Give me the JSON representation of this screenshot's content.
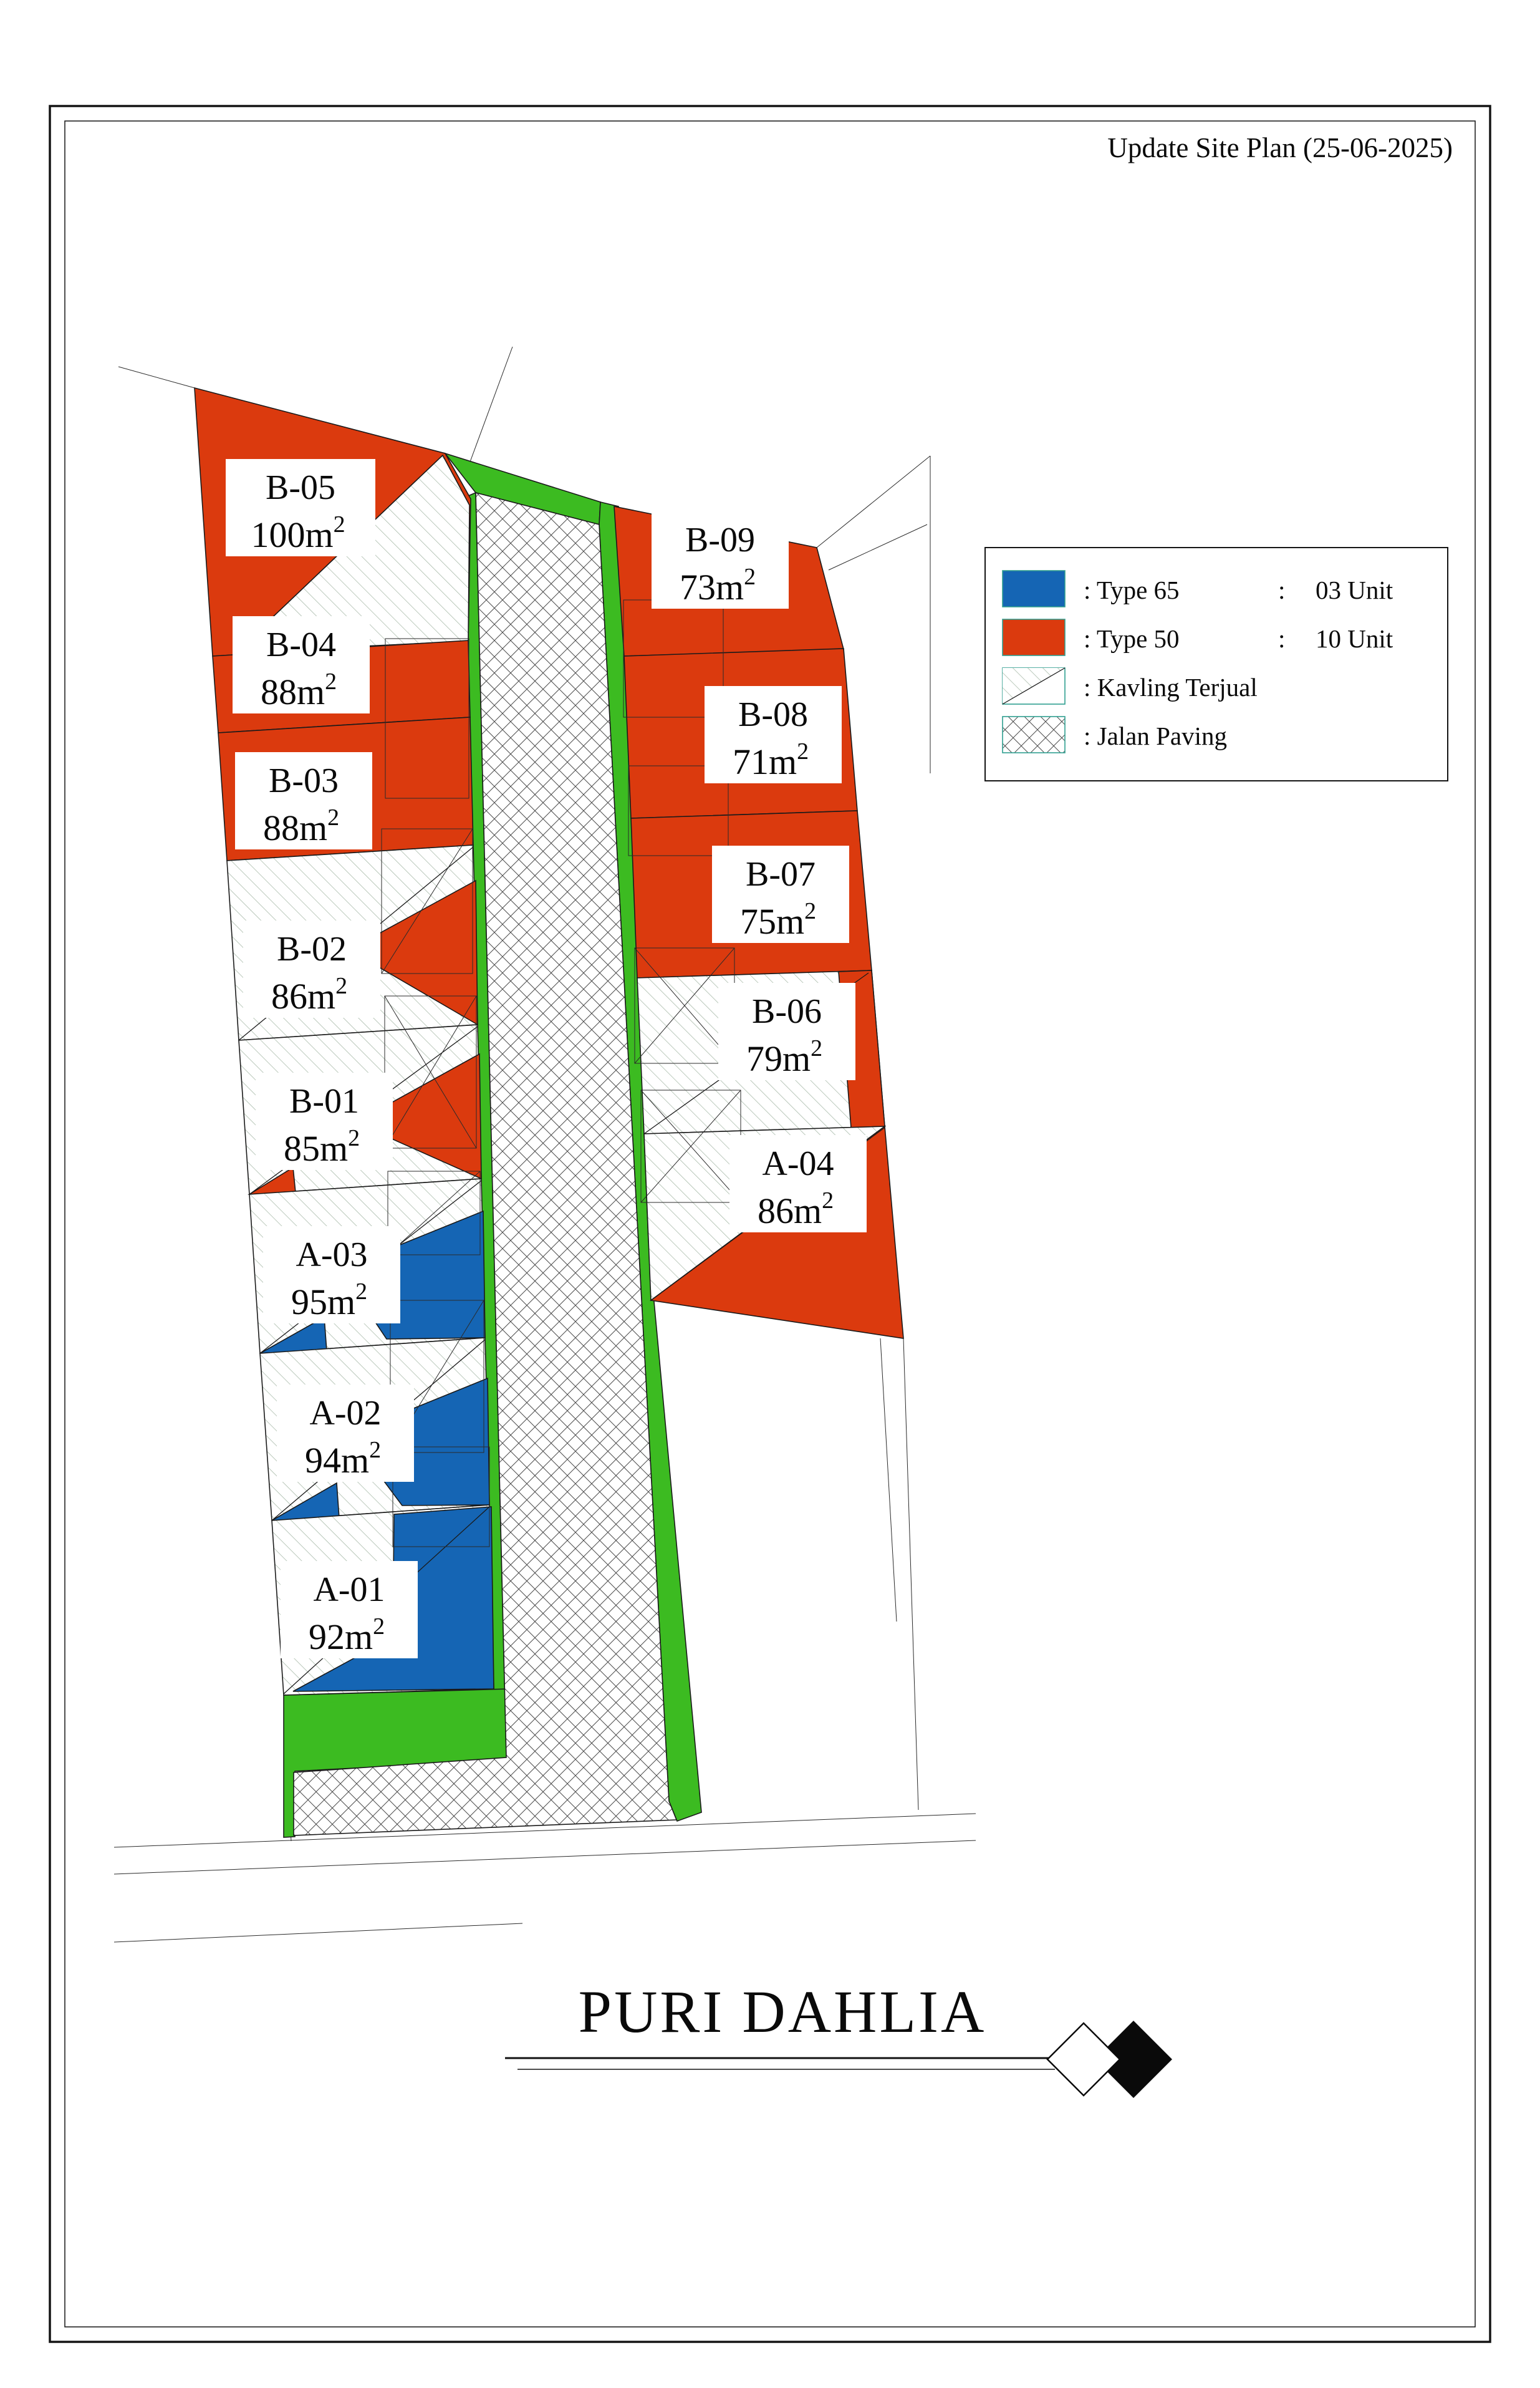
{
  "header": {
    "title": "Update Site Plan (25-06-2025)"
  },
  "legend": {
    "rows": [
      {
        "swatch": "type65-swatch",
        "label": ": Type 65",
        "separator": ":",
        "count": "03 Unit"
      },
      {
        "swatch": "type50-swatch",
        "label": ": Type 50",
        "separator": ":",
        "count": "10 Unit"
      },
      {
        "swatch": "kavling-terjual-swatch",
        "label": ": Kavling Terjual"
      },
      {
        "swatch": "jalan-paving-swatch",
        "label": ": Jalan Paving"
      }
    ]
  },
  "lots": [
    {
      "id": "B-05",
      "area": "100m",
      "area_sup": "2",
      "type": "Type 50",
      "sold": true
    },
    {
      "id": "B-04",
      "area": "88m",
      "area_sup": "2",
      "type": "Type 50",
      "sold": false
    },
    {
      "id": "B-03",
      "area": "88m",
      "area_sup": "2",
      "type": "Type 50",
      "sold": false
    },
    {
      "id": "B-02",
      "area": "86m",
      "area_sup": "2",
      "type": "Type 50",
      "sold": true
    },
    {
      "id": "B-01",
      "area": "85m",
      "area_sup": "2",
      "type": "Type 50",
      "sold": true
    },
    {
      "id": "A-03",
      "area": "95m",
      "area_sup": "2",
      "type": "Type 65",
      "sold": true
    },
    {
      "id": "A-02",
      "area": "94m",
      "area_sup": "2",
      "type": "Type 65",
      "sold": true
    },
    {
      "id": "A-01",
      "area": "92m",
      "area_sup": "2",
      "type": "Type 65",
      "sold": true
    },
    {
      "id": "B-09",
      "area": "73m",
      "area_sup": "2",
      "type": "Type 50",
      "sold": false
    },
    {
      "id": "B-08",
      "area": "71m",
      "area_sup": "2",
      "type": "Type 50",
      "sold": false
    },
    {
      "id": "B-07",
      "area": "75m",
      "area_sup": "2",
      "type": "Type 50",
      "sold": false
    },
    {
      "id": "B-06",
      "area": "79m",
      "area_sup": "2",
      "type": "Type 50",
      "sold": true
    },
    {
      "id": "A-04",
      "area": "86m",
      "area_sup": "2",
      "type": "Type 50",
      "sold": true
    }
  ],
  "footer": {
    "project_name": "PURI DAHLIA"
  },
  "colors": {
    "type65": "#1565B4",
    "type50": "#DB3A0E",
    "green": "#3CBB21",
    "hatch": "#9fb3a0",
    "paving": "#4d4d4d",
    "teal": "#2f9e8f"
  }
}
